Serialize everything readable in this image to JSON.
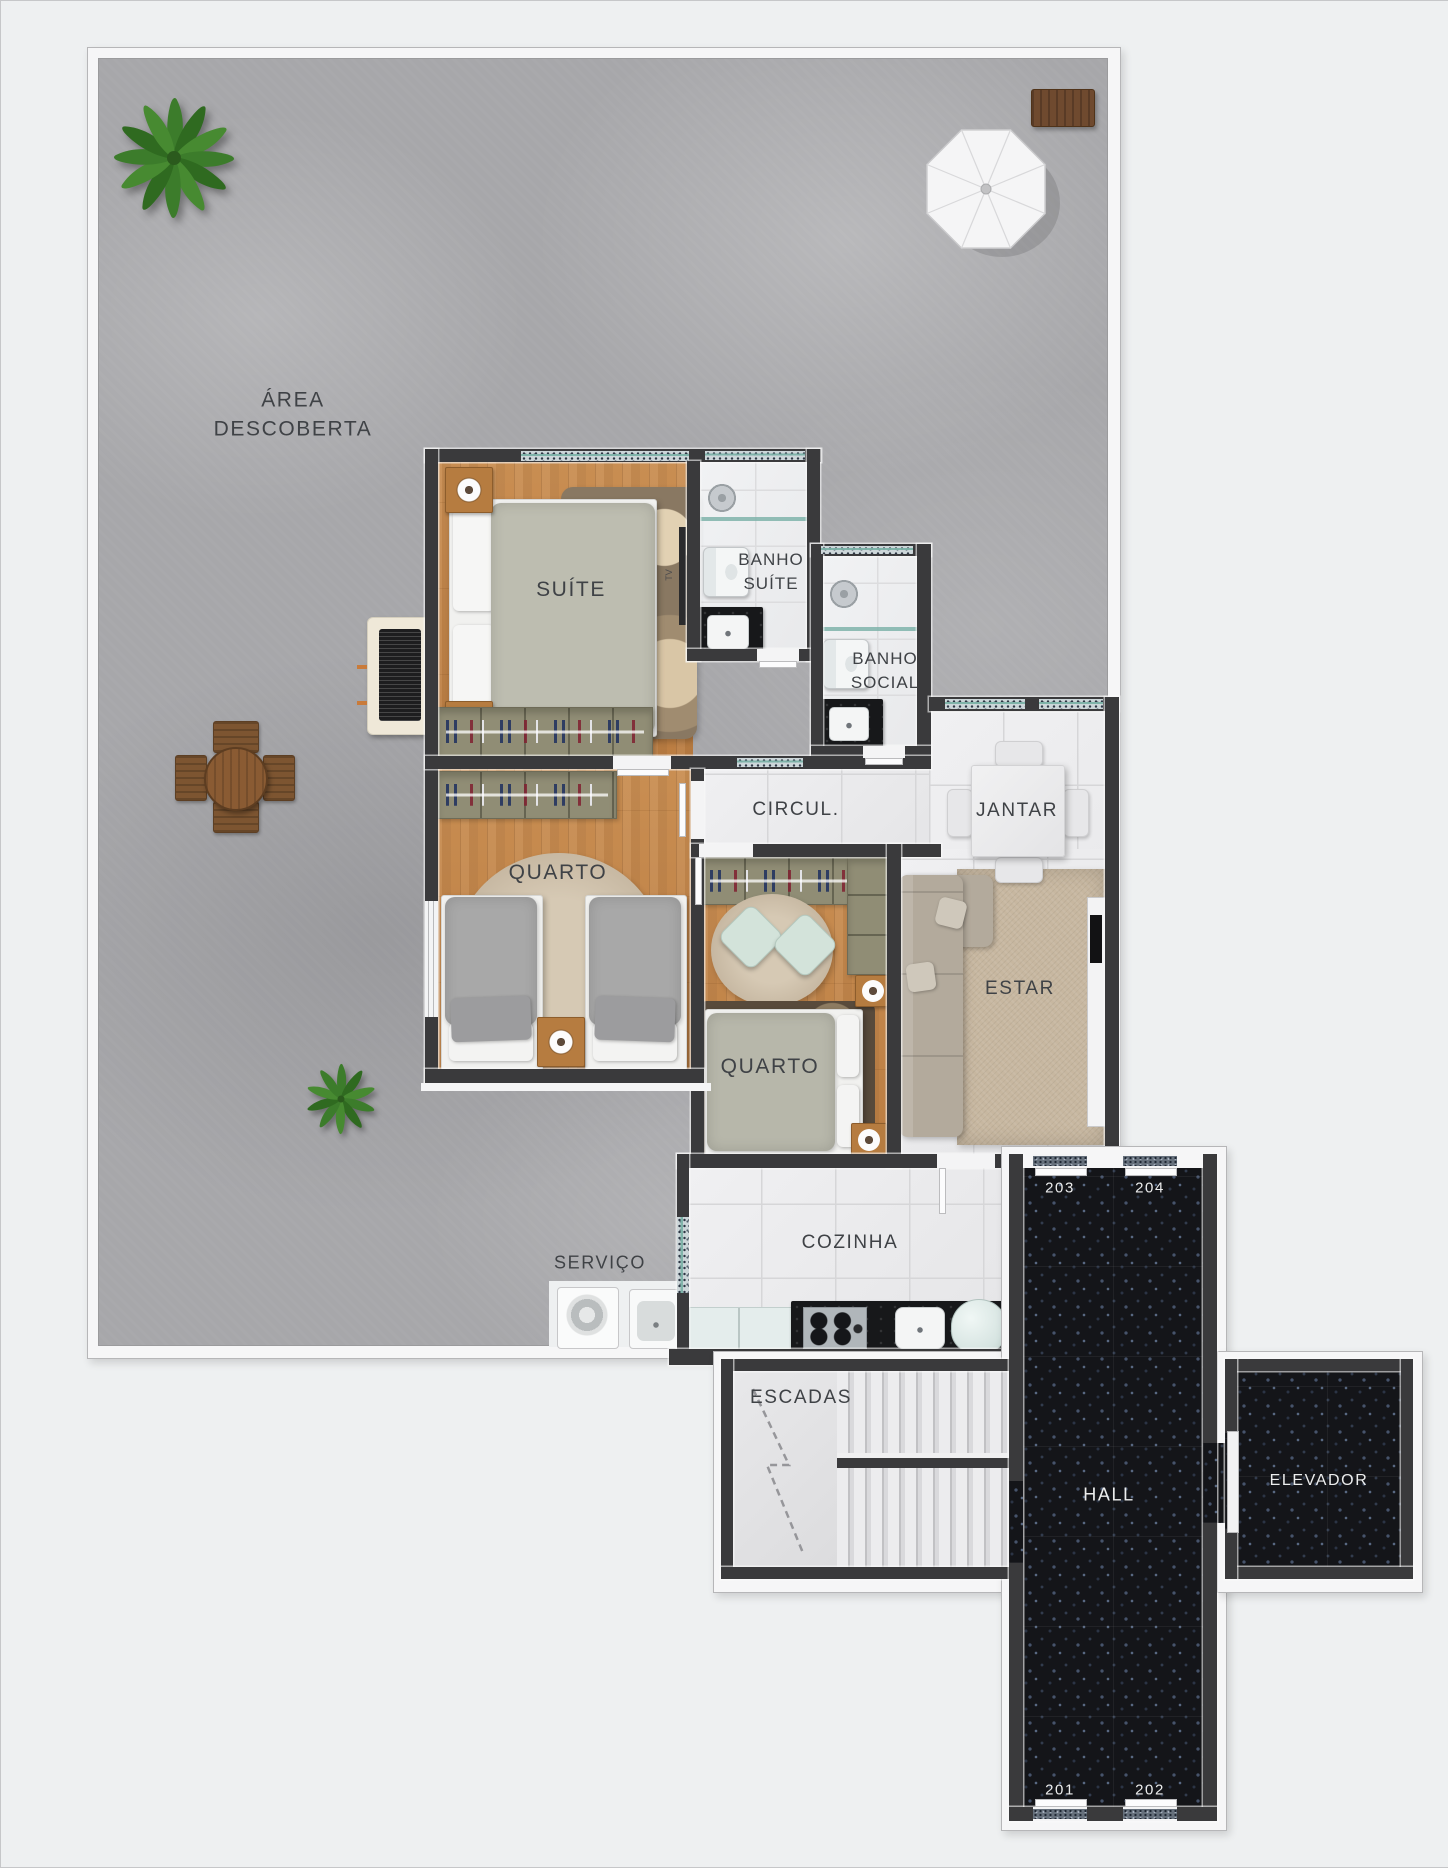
{
  "scene": {
    "type": "apartment-floor-plan",
    "floor_units_shown": [
      "201",
      "202",
      "203",
      "204"
    ]
  },
  "labels": {
    "area": {
      "line1": "ÁREA",
      "line2": "DESCOBERTA"
    }
  },
  "rooms": {
    "suite": {
      "label": "SUÍTE"
    },
    "banho_suite": {
      "line1": "BANHO",
      "line2": "SUÍTE"
    },
    "banho_social": {
      "line1": "BANHO",
      "line2": "SOCIAL"
    },
    "circulacao": {
      "label": "CIRCUL."
    },
    "jantar": {
      "label": "JANTAR"
    },
    "quarto_1": {
      "label": "QUARTO"
    },
    "quarto_2": {
      "label": "QUARTO"
    },
    "estar": {
      "label": "ESTAR"
    },
    "cozinha": {
      "label": "COZINHA"
    },
    "servico": {
      "label": "SERVIÇO"
    },
    "escadas": {
      "label": "ESCADAS"
    },
    "hall": {
      "label": "HALL"
    },
    "elevador": {
      "label": "ELEVADOR"
    }
  },
  "units": {
    "u203": "203",
    "u204": "204",
    "u201": "201",
    "u202": "202"
  },
  "annotations": {
    "tv": "TV"
  },
  "colors": {
    "wall": "#3a3a3c",
    "concrete": "#a7a7aa",
    "wood_floor": "#c28349",
    "white_tile": "#ececee",
    "marble": "#edeef0",
    "granite_dark": "#141519",
    "wardrobe_olive": "#908d75",
    "glass_teal": "#7fb3aa",
    "rug_beige": "#c7b7a0",
    "sofa": "#b3aa9c",
    "pouf_mint": "#d3e3da",
    "label_text": "#3f4246",
    "unit_text": "#eceded"
  }
}
